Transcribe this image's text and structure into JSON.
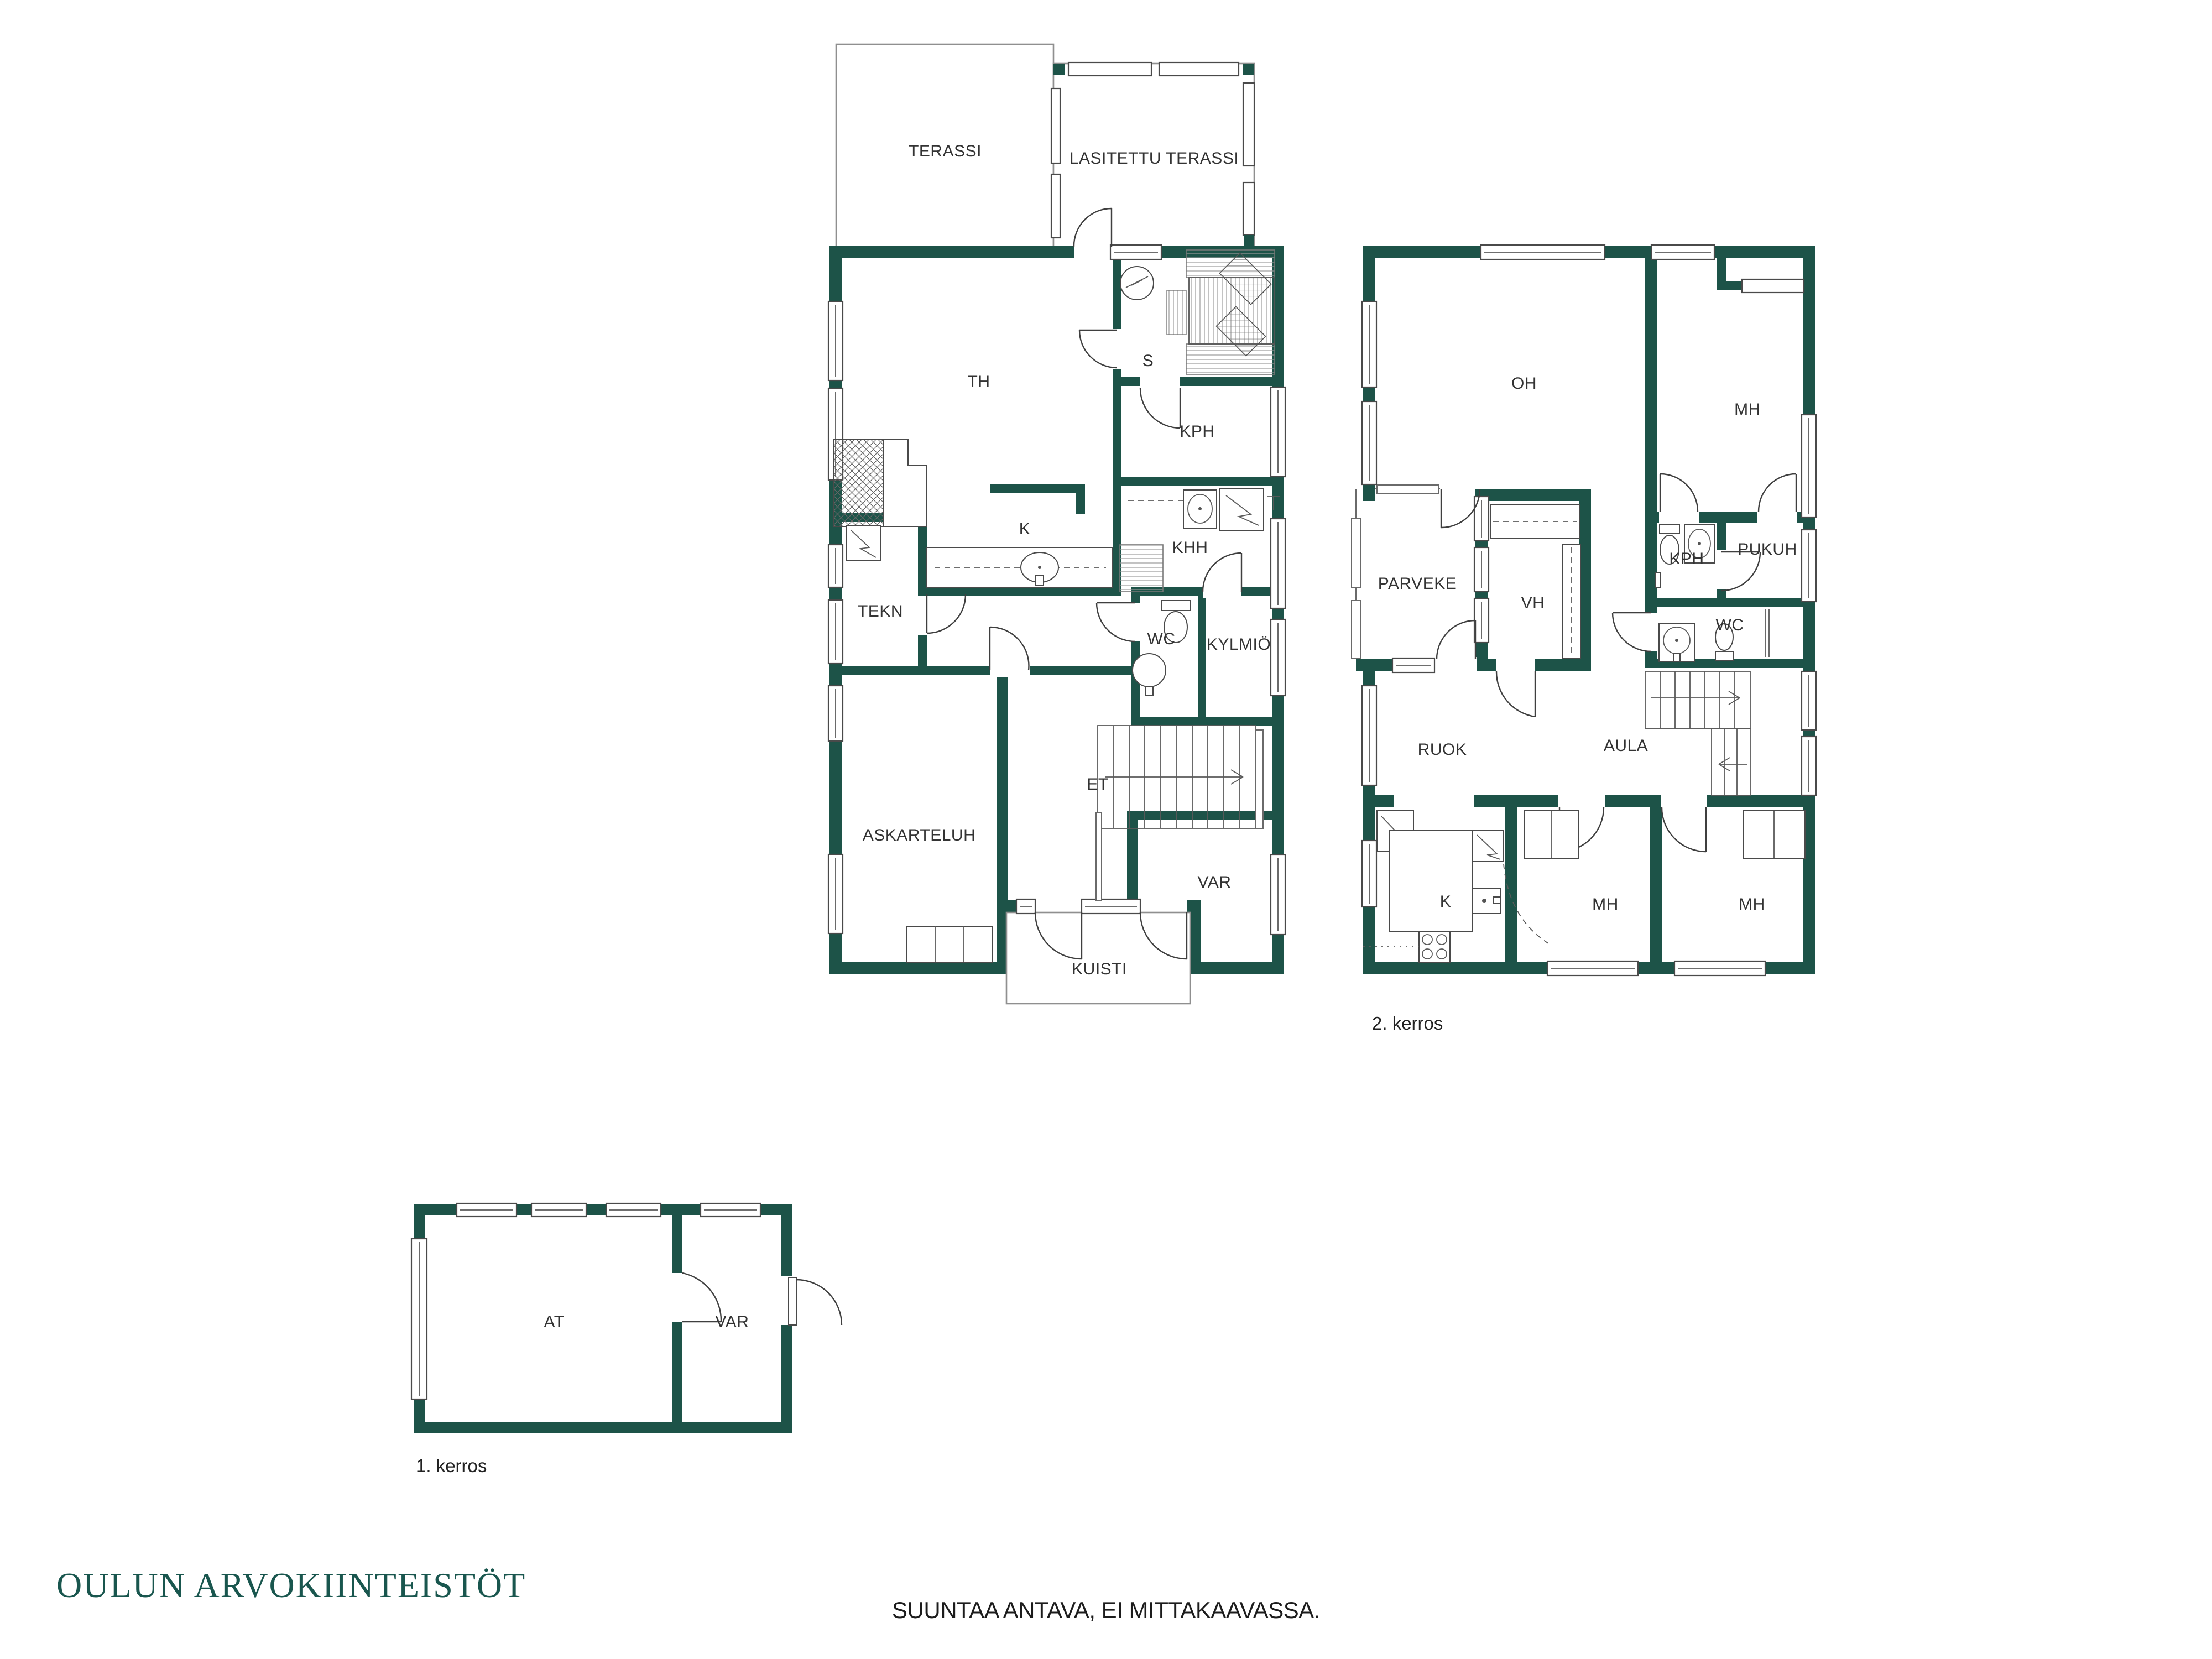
{
  "branding": {
    "logo_text": "OULUN ARVOKIINTEISTÖT"
  },
  "footer": {
    "disclaimer": "SUUNTAA ANTAVA, EI MITTAKAAVASSA."
  },
  "colors": {
    "wall": "#1d5348",
    "line": "#3f3f3f",
    "thin_outline": "#8f8f8f",
    "label": "#333333",
    "logo": "#19564e"
  },
  "plans": {
    "floor1": {
      "rooms": {
        "terassi": "TERASSI",
        "lasitettu_terassi": "LASITETTU TERASSI",
        "th": "TH",
        "s": "S",
        "kph": "KPH",
        "khh": "KHH",
        "k": "K",
        "tekn": "TEKN",
        "wc": "WC",
        "kylmio": "KYLMIÖ",
        "et": "ET",
        "askarteluh": "ASKARTELUH",
        "var": "VAR",
        "kuisti": "KUISTI"
      }
    },
    "floor2": {
      "caption": "2. kerros",
      "rooms": {
        "oh": "OH",
        "mh1": "MH",
        "kph": "KPH",
        "pukuh": "PUKUH",
        "parveke": "PARVEKE",
        "vh": "VH",
        "wc": "WC",
        "ruok": "RUOK",
        "aula": "AULA",
        "k": "K",
        "mh2": "MH",
        "mh3": "MH"
      }
    },
    "outbuilding": {
      "caption": "1. kerros",
      "rooms": {
        "at": "AT",
        "var": "VAR"
      }
    }
  }
}
